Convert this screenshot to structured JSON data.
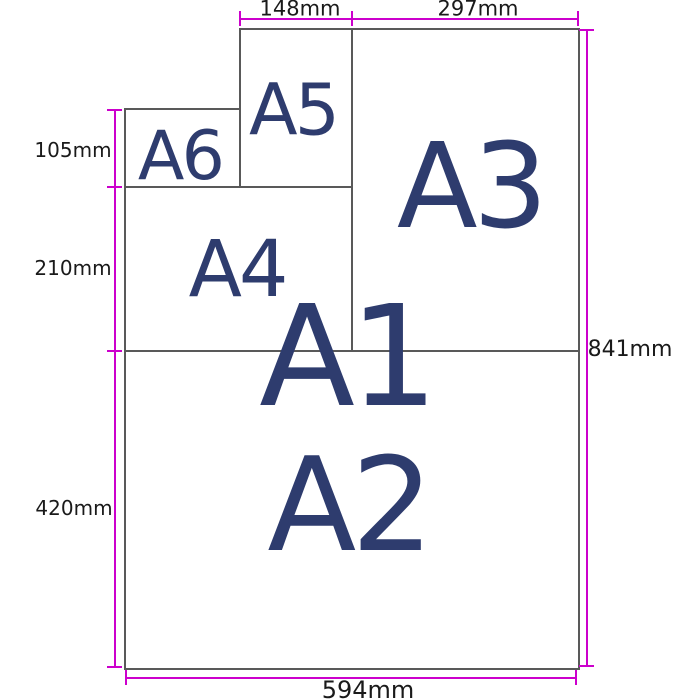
{
  "diagram": {
    "papers": {
      "a1": "A1",
      "a2": "A2",
      "a3": "A3",
      "a4": "A4",
      "a5": "A5",
      "a6": "A6"
    },
    "dimensions": {
      "a5_width": "148mm",
      "a3_width": "297mm",
      "a6_height": "105mm",
      "a4_height": "210mm",
      "a2_height": "420mm",
      "a1_height": "841mm",
      "a1_width": "594mm"
    },
    "colors": {
      "dimension_line": "#cc00cc",
      "paper_border": "#595959",
      "paper_label_text": "#2e3c6e",
      "dimension_text": "#1a1a1a",
      "background": "#ffffff"
    }
  }
}
